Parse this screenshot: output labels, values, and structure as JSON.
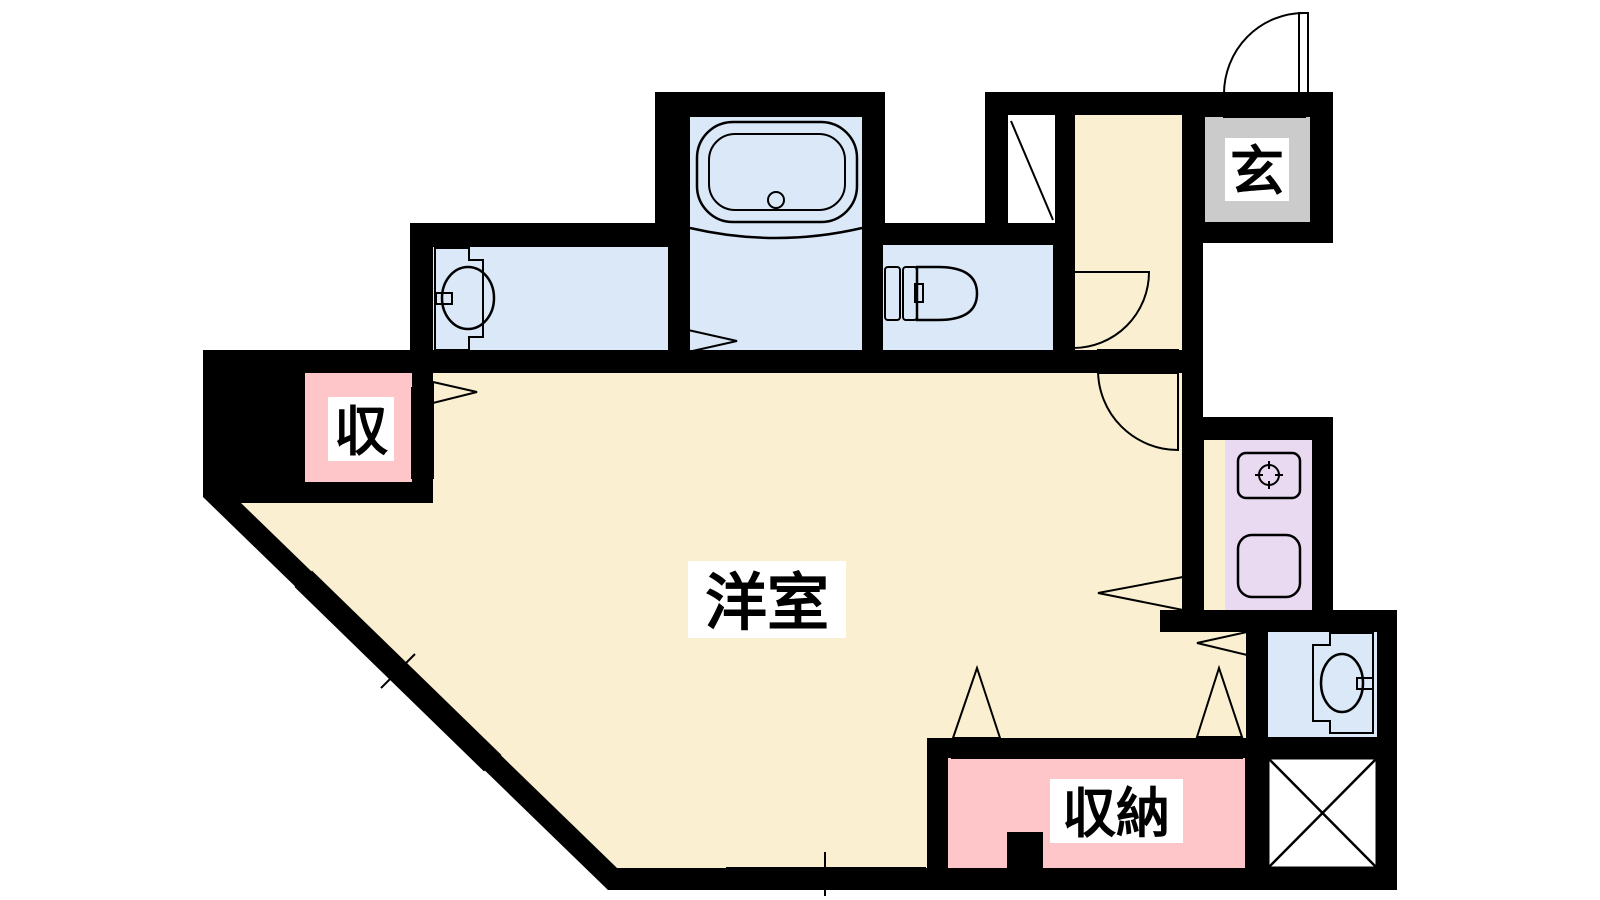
{
  "floorplan": {
    "title": "apartment-floor-plan",
    "labels": {
      "entrance": "玄",
      "storage_small": "収",
      "storage_large": "収納",
      "western_room": "洋室"
    },
    "colors": {
      "wall": "#000000",
      "paper": "#ffffff",
      "room_floor": "#FAF0D1",
      "wet_area": "#DAE8F8",
      "storage": "#FFC6C9",
      "kitchen_counter": "#E9D9F1",
      "entrance_floor": "#CBCBCB",
      "fixture_line": "#000000"
    },
    "rooms": [
      {
        "name": "western-room",
        "label": "洋室"
      },
      {
        "name": "entrance-genkan",
        "label": "玄"
      },
      {
        "name": "storage-small",
        "label": "収"
      },
      {
        "name": "storage-large",
        "label": "収納"
      },
      {
        "name": "bathroom-with-tub",
        "label": ""
      },
      {
        "name": "washroom-vanity",
        "label": ""
      },
      {
        "name": "toilet-room",
        "label": ""
      },
      {
        "name": "hallway",
        "label": ""
      },
      {
        "name": "kitchen",
        "label": ""
      },
      {
        "name": "washbasin-room",
        "label": ""
      },
      {
        "name": "pipe-space",
        "label": ""
      }
    ]
  }
}
